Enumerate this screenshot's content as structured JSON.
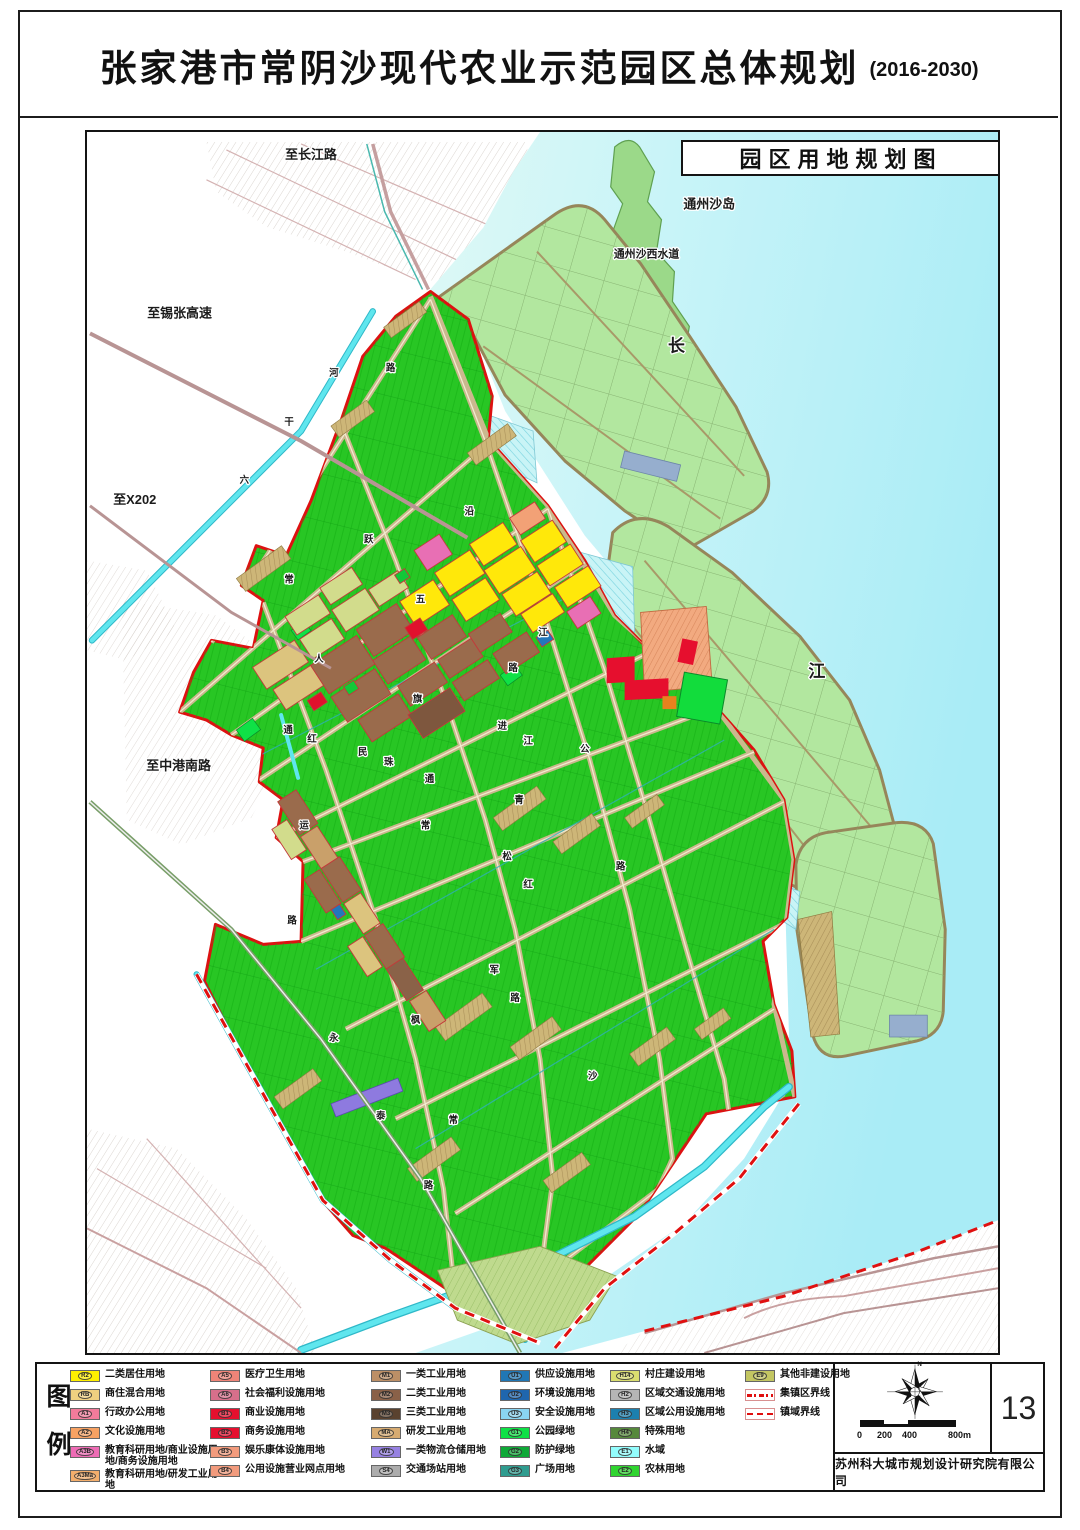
{
  "page": {
    "title": "张家港市常阴沙现代农业示范园区总体规划",
    "title_suffix": "(2016-2030)",
    "page_number": "13",
    "company": "苏州科大城市规划设计研究院有限公司"
  },
  "map": {
    "box_title": "园区用地规划图",
    "labels": [
      {
        "t": "至长江路",
        "x": 225,
        "y": 27,
        "s": 13
      },
      {
        "t": "至锡张高速",
        "x": 93,
        "y": 186,
        "s": 13
      },
      {
        "t": "至X202",
        "x": 48,
        "y": 373,
        "s": 13
      },
      {
        "t": "至中港南路",
        "x": 92,
        "y": 640,
        "s": 13
      },
      {
        "t": "通州沙岛",
        "x": 625,
        "y": 77,
        "s": 13
      },
      {
        "t": "通州沙西水道",
        "x": 562,
        "y": 126,
        "s": 11,
        "c": "#2FA8A2"
      },
      {
        "t": "长",
        "x": 592,
        "y": 220,
        "s": 17
      },
      {
        "t": "江",
        "x": 733,
        "y": 547,
        "s": 17
      },
      {
        "t": "六",
        "x": 158,
        "y": 352
      },
      {
        "t": "干",
        "x": 203,
        "y": 294
      },
      {
        "t": "河",
        "x": 248,
        "y": 245
      },
      {
        "t": "路",
        "x": 305,
        "y": 240
      },
      {
        "t": "跃",
        "x": 283,
        "y": 412
      },
      {
        "t": "常",
        "x": 203,
        "y": 452
      },
      {
        "t": "五",
        "x": 335,
        "y": 472
      },
      {
        "t": "沿",
        "x": 384,
        "y": 384
      },
      {
        "t": "江",
        "x": 458,
        "y": 505
      },
      {
        "t": "路",
        "x": 428,
        "y": 541
      },
      {
        "t": "进",
        "x": 417,
        "y": 599
      },
      {
        "t": "江",
        "x": 443,
        "y": 614
      },
      {
        "t": "公",
        "x": 500,
        "y": 622
      },
      {
        "t": "路",
        "x": 536,
        "y": 740
      },
      {
        "t": "人",
        "x": 233,
        "y": 532
      },
      {
        "t": "通",
        "x": 202,
        "y": 603
      },
      {
        "t": "红",
        "x": 226,
        "y": 612
      },
      {
        "t": "民",
        "x": 277,
        "y": 625
      },
      {
        "t": "珠",
        "x": 303,
        "y": 635
      },
      {
        "t": "旗",
        "x": 332,
        "y": 572
      },
      {
        "t": "通",
        "x": 344,
        "y": 652
      },
      {
        "t": "运",
        "x": 218,
        "y": 699
      },
      {
        "t": "路",
        "x": 206,
        "y": 794
      },
      {
        "t": "青",
        "x": 434,
        "y": 673
      },
      {
        "t": "松",
        "x": 422,
        "y": 730
      },
      {
        "t": "红",
        "x": 443,
        "y": 758
      },
      {
        "t": "常",
        "x": 340,
        "y": 699
      },
      {
        "t": "军",
        "x": 409,
        "y": 844
      },
      {
        "t": "路",
        "x": 430,
        "y": 872
      },
      {
        "t": "枫",
        "x": 330,
        "y": 894
      },
      {
        "t": "永",
        "x": 248,
        "y": 912
      },
      {
        "t": "泰",
        "x": 295,
        "y": 990
      },
      {
        "t": "常",
        "x": 368,
        "y": 994
      },
      {
        "t": "沙",
        "x": 508,
        "y": 950
      },
      {
        "t": "路",
        "x": 343,
        "y": 1060
      }
    ]
  },
  "legend": {
    "heading": "图例",
    "columns": [
      [
        {
          "code": "R2",
          "label": "二类居住用地",
          "color": "#FFF000"
        },
        {
          "code": "RB",
          "label": "商住混合用地",
          "color": "#F0D080"
        },
        {
          "code": "A1",
          "label": "行政办公用地",
          "color": "#F27B9B"
        },
        {
          "code": "A2",
          "label": "文化设施用地",
          "color": "#F7A263"
        },
        {
          "code": "A3B",
          "label": "教育科研用地/商业设施用地/商务设施用地",
          "color": "#EE6CB5"
        },
        {
          "code": "A3Ma",
          "label": "教育科研用地/研发工业用地",
          "color": "#F3AE6C"
        }
      ],
      [
        {
          "code": "A5",
          "label": "医疗卫生用地",
          "color": "#EF8478"
        },
        {
          "code": "A6",
          "label": "社会福利设施用地",
          "color": "#D76F8B"
        },
        {
          "code": "B1",
          "label": "商业设施用地",
          "color": "#E60F2E"
        },
        {
          "code": "B2",
          "label": "商务设施用地",
          "color": "#E60F2E"
        },
        {
          "code": "B3",
          "label": "娱乐康体设施用地",
          "color": "#F29B7D"
        },
        {
          "code": "B4",
          "label": "公用设施营业网点用地",
          "color": "#F29B7D"
        }
      ],
      [
        {
          "code": "M1",
          "label": "一类工业用地",
          "color": "#BC8F66"
        },
        {
          "code": "M2",
          "label": "二类工业用地",
          "color": "#8A6148"
        },
        {
          "code": "M3",
          "label": "三类工业用地",
          "color": "#5A422F"
        },
        {
          "code": "MA",
          "label": "研发工业用地",
          "color": "#D7AB71"
        },
        {
          "code": "W1",
          "label": "一类物流仓储用地",
          "color": "#9681E2"
        },
        {
          "code": "S4",
          "label": "交通场站用地",
          "color": "#ACACAC"
        }
      ],
      [
        {
          "code": "U1",
          "label": "供应设施用地",
          "color": "#2077B5"
        },
        {
          "code": "U2",
          "label": "环境设施用地",
          "color": "#1F66AE"
        },
        {
          "code": "U3",
          "label": "安全设施用地",
          "color": "#8AD5F2"
        },
        {
          "code": "G1",
          "label": "公园绿地",
          "color": "#0FE146"
        },
        {
          "code": "G2",
          "label": "防护绿地",
          "color": "#0FA937"
        },
        {
          "code": "G3",
          "label": "广场用地",
          "color": "#2F9C8F"
        }
      ],
      [
        {
          "code": "H14",
          "label": "村庄建设用地",
          "color": "#DADE6F"
        },
        {
          "code": "H2",
          "label": "区域交通设施用地",
          "color": "#B5B5B5"
        },
        {
          "code": "H3",
          "label": "区域公用设施用地",
          "color": "#1C80AF"
        },
        {
          "code": "H4",
          "label": "特殊用地",
          "color": "#56893C"
        },
        {
          "code": "E1",
          "label": "水域",
          "color": "#93FDFD"
        },
        {
          "code": "E2",
          "label": "农林用地",
          "color": "#2FD42F"
        }
      ],
      [
        {
          "code": "E9",
          "label": "其他非建设用地",
          "color": "#C3C662"
        },
        {
          "code": "",
          "label": "集镇区界线",
          "type": "dashdot"
        },
        {
          "code": "",
          "label": "镇域界线",
          "type": "dash"
        }
      ]
    ]
  },
  "scalebar": {
    "labels": [
      "0",
      "200",
      "400",
      "800m"
    ]
  },
  "compass": {
    "north_label": "N"
  }
}
